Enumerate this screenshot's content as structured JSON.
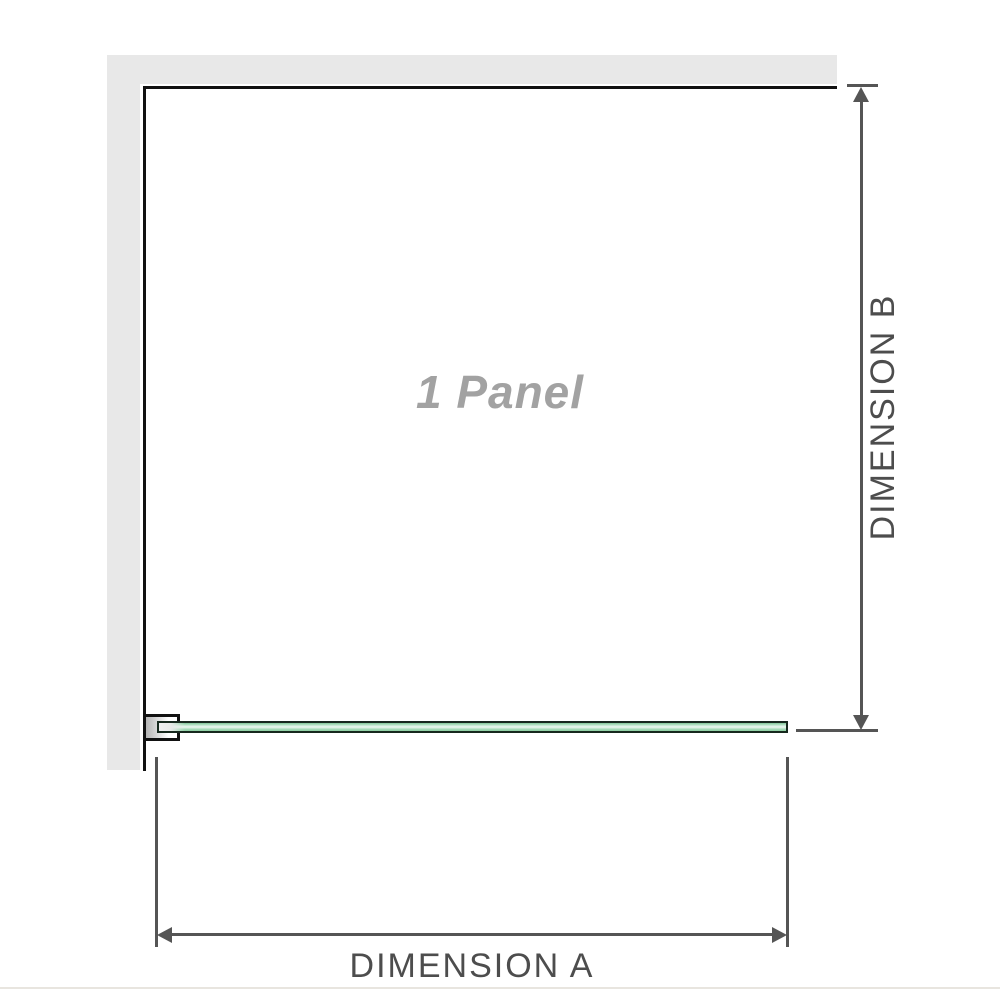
{
  "diagram": {
    "title": "1 Panel",
    "dimension_a": {
      "label": "DIMENSION A"
    },
    "dimension_b": {
      "label": "DIMENSION B"
    }
  },
  "icons": {
    "dimension_b_top": "arrow-up-icon",
    "dimension_b_bottom": "arrow-down-icon",
    "dimension_a_left": "arrow-left-icon",
    "dimension_a_right": "arrow-right-icon"
  },
  "colors": {
    "wall": "#e8e8e8",
    "panel_outline": "#111111",
    "dimension_line": "#555555",
    "dimension_text": "#4d4d4d",
    "panel_title_text": "#a2a2a2",
    "glass_border": "#16281d",
    "glass_fill": "#9fd8b4",
    "glass_highlight": "#eef9f2",
    "footer_rule": "#e8e5df"
  }
}
